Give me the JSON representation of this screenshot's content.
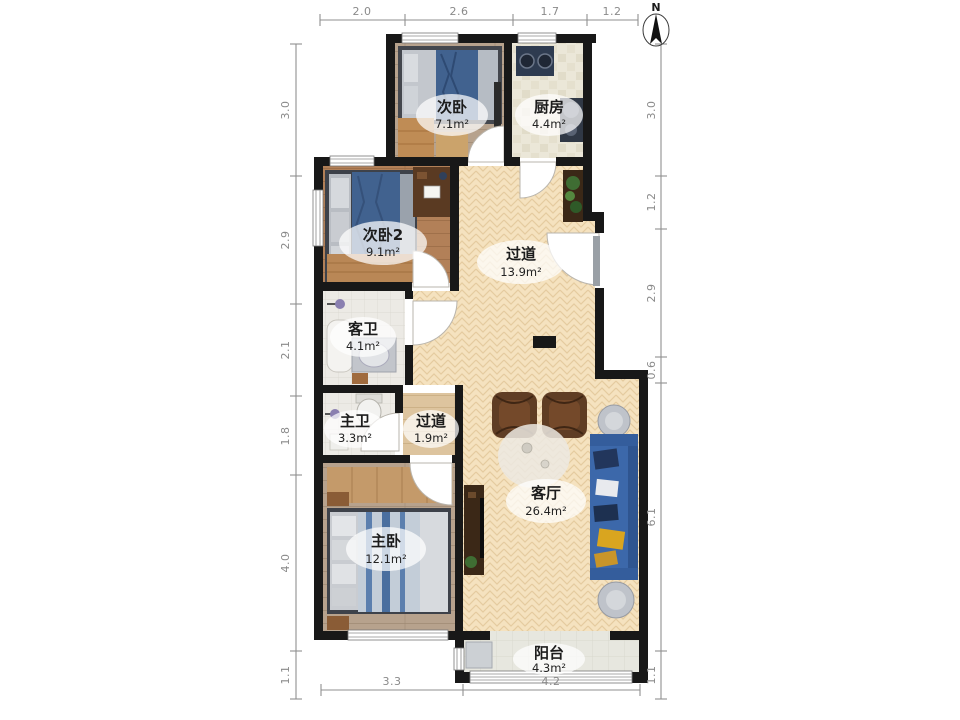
{
  "compass": {
    "label": "N"
  },
  "dimensions": {
    "top": [
      "2.0",
      "2.6",
      "1.7",
      "1.2"
    ],
    "bottom": [
      "3.3",
      "4.2"
    ],
    "left": [
      "3.0",
      "2.9",
      "2.1",
      "1.8",
      "4.0",
      "1.1"
    ],
    "right": [
      "3.0",
      "1.2",
      "2.9",
      "0.6",
      "6.1",
      "1.1"
    ]
  },
  "rooms": {
    "bedroom_second": {
      "name": "次卧",
      "area": "7.1m²"
    },
    "kitchen": {
      "name": "厨房",
      "area": "4.4m²"
    },
    "bedroom_second2": {
      "name": "次卧2",
      "area": "9.1m²"
    },
    "hallway": {
      "name": "过道",
      "area": "13.9m²"
    },
    "guest_bath": {
      "name": "客卫",
      "area": "4.1m²"
    },
    "master_bath": {
      "name": "主卫",
      "area": "3.3m²"
    },
    "corridor": {
      "name": "过道",
      "area": "1.9m²"
    },
    "master_bedroom": {
      "name": "主卧",
      "area": "12.1m²"
    },
    "living_room": {
      "name": "客厅",
      "area": "26.4m²"
    },
    "balcony": {
      "name": "阳台",
      "area": "4.3m²"
    }
  },
  "colors": {
    "wall": "#181818",
    "dim_line": "#8f8f8f",
    "herringbone_floor": "#f5e2bf",
    "wood_gray": "#b7a28d",
    "wood_brown": "#b28058",
    "corridor_wood": "#ddc49e",
    "kitchen_tile": "#ebe7d8",
    "bath_tile": "#eceae5",
    "balcony_tile": "#e7e7df",
    "sofa_blue": "#3c68aa",
    "bed_blue": "#41628f",
    "armchair_brown": "#5f3d24",
    "cabinet_dark": "#3b2817",
    "accent_yellow": "#d9a51f"
  }
}
